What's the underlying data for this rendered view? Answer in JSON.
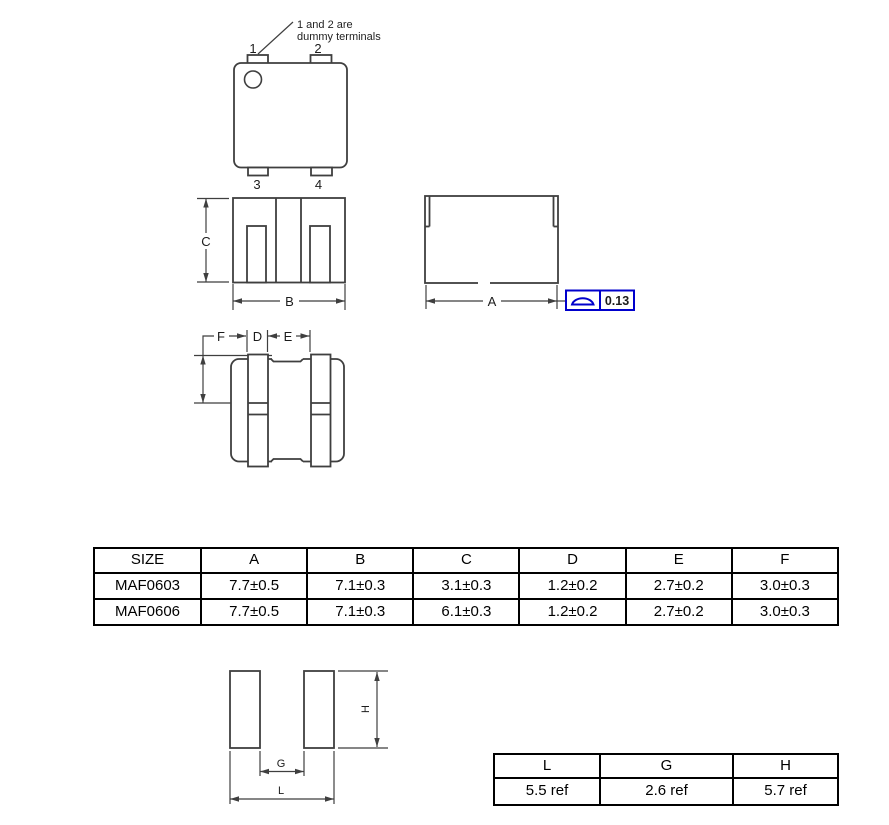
{
  "colors": {
    "line": "#3f3f3f",
    "accent_blue": "#0000cc",
    "table_border": "#000000"
  },
  "top_view": {
    "note_line1": "1 and 2 are",
    "note_line2": "dummy terminals",
    "terminal_1": "1",
    "terminal_2": "2",
    "terminal_3": "3",
    "terminal_4": "4"
  },
  "front_view": {
    "dim_c": "C",
    "dim_b": "B"
  },
  "side_view": {
    "dim_a": "A",
    "flatness_value": "0.13"
  },
  "bottom_view": {
    "dim_f": "F",
    "dim_d": "D",
    "dim_e": "E"
  },
  "land_pattern": {
    "dim_h": "H",
    "dim_g": "G",
    "dim_l": "L"
  },
  "dimension_table": {
    "headers": [
      "SIZE",
      "A",
      "B",
      "C",
      "D",
      "E",
      "F"
    ],
    "rows": [
      {
        "size": "MAF0603",
        "a": "7.7±0.5",
        "b": "7.1±0.3",
        "c": "3.1±0.3",
        "d": "1.2±0.2",
        "e": "2.7±0.2",
        "f": "3.0±0.3"
      },
      {
        "size": "MAF0606",
        "a": "7.7±0.5",
        "b": "7.1±0.3",
        "c": "6.1±0.3",
        "d": "1.2±0.2",
        "e": "2.7±0.2",
        "f": "3.0±0.3"
      }
    ]
  },
  "land_table": {
    "headers": [
      "L",
      "G",
      "H"
    ],
    "values": [
      "5.5 ref",
      "2.6 ref",
      "5.7 ref"
    ]
  }
}
